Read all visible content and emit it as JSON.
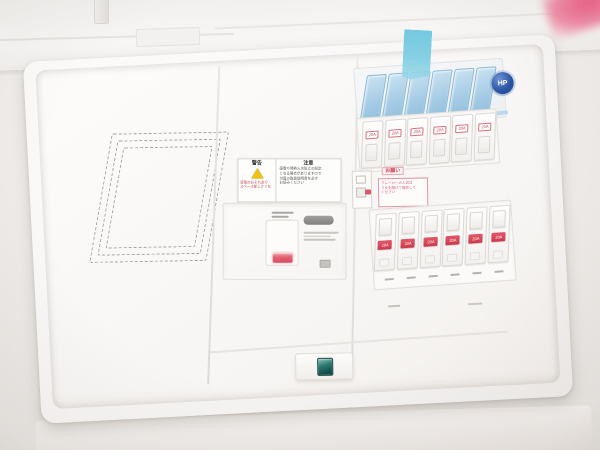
{
  "badge": {
    "text": "HP"
  },
  "warning_sticker": {
    "left_title": "警告",
    "left_lines": [
      "感電のおそれあり",
      "スペース部ふさぐな"
    ],
    "right_title": "注意",
    "right_lines": [
      "感電や発熱火災防止の設定",
      "となる場合がありますので",
      "付属の取扱説明書を必ず",
      "お読みください"
    ]
  },
  "notice_sticker": {
    "title": "お願い",
    "lines": [
      "ブレーカーの入切は",
      "フタを開けて操作して",
      "ください"
    ]
  },
  "main_breaker": {
    "micro_top_lines": 3,
    "micro_side_lines": 3
  },
  "breakers": {
    "blue_covers": {
      "count": 6
    },
    "row1": {
      "count": 6,
      "label": "20A"
    },
    "row2": {
      "count": 6,
      "label": "20A"
    },
    "label_strip": {
      "count": 6
    }
  },
  "colors": {
    "tape_blue": "#7ccde2",
    "cover_blue": "#a2cae4",
    "label_red": "#cb4353",
    "latch_teal": "#1f5f5c",
    "badge_blue": "#2d57a6",
    "warning_yellow": "#f0c113",
    "panel_white": "#f8f6f5"
  }
}
